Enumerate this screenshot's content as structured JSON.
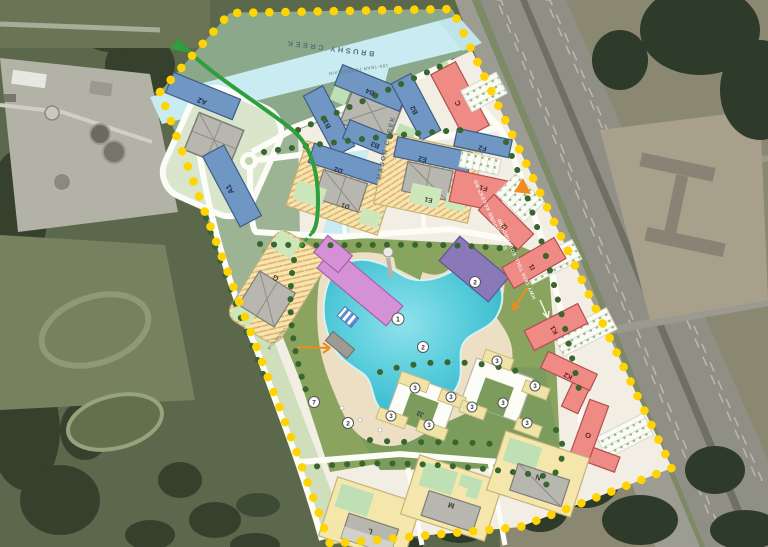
{
  "colors": {
    "boundary": "#ffd400",
    "lagoon": "#46c6d6",
    "creek": "#c9ecf2",
    "floodplain_green": "#8ba88a",
    "park_green": "#7c9c5d",
    "residential_blue": "#7096c4",
    "retail_red": "#ef8a85",
    "podium_yellow": "#f5e7ab",
    "amenity_pink": "#d591d6",
    "amenity_purple": "#8a79b8",
    "trail_green": "#2f9e3d"
  },
  "labels": {
    "brushy_creek": "BRUSHY CREEK",
    "mason_creek": "MASON CREEK",
    "floodplain": "100-YEAR FLOODPLAIN",
    "access_road": "SOUTHBOUND ACCESS RD",
    "highway": "HWY 183A TOLL SOUTHBOUND",
    "lagoon_club": "LAGOON CLUB"
  },
  "buildings": {
    "a1": {
      "label": "A1"
    },
    "a2": {
      "label": "A2"
    },
    "b1": {
      "label": "B1"
    },
    "b2": {
      "label": "B2"
    },
    "b3": {
      "label": "B3"
    },
    "b4": {
      "label": "B4"
    },
    "c": {
      "label": "C"
    },
    "d1": {
      "label": "D1"
    },
    "d2": {
      "label": "D2"
    },
    "e1": {
      "label": "E1"
    },
    "e2": {
      "label": "E2"
    },
    "f1": {
      "label": "F1"
    },
    "f2": {
      "label": "F2"
    },
    "g": {
      "label": "G"
    },
    "i1": {
      "label": "I1"
    },
    "i2": {
      "label": "I2"
    },
    "j2": {
      "label": "J2"
    },
    "k1": {
      "label": "K1"
    },
    "k2": {
      "label": "K2"
    },
    "l": {
      "label": "L"
    },
    "m": {
      "label": "M"
    },
    "n": {
      "label": "N"
    },
    "o": {
      "label": "O"
    }
  },
  "markers": {
    "lagoon": "1",
    "beach": "2",
    "residential": "3",
    "boardwalk": "7"
  }
}
